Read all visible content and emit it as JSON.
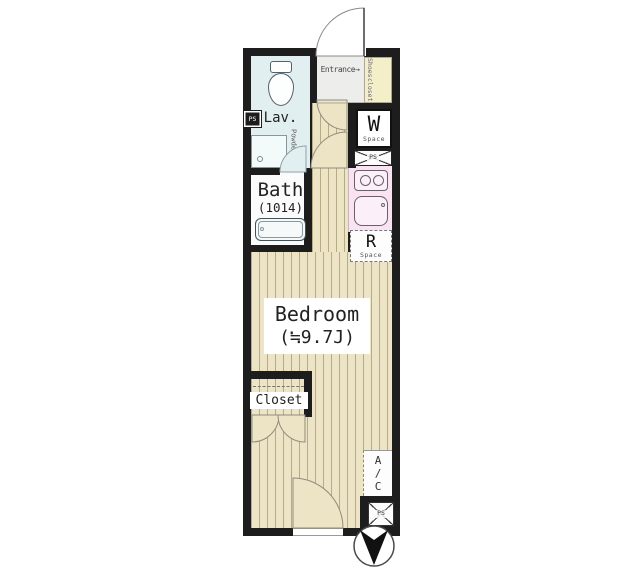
{
  "plan": {
    "entrance": {
      "label": "Entrance",
      "arrow": "→"
    },
    "shoes_closet": {
      "line1": "Shoes",
      "line2": "closet"
    },
    "lav": {
      "label": "Lav."
    },
    "powder": {
      "line1": "Powder",
      "line2": "Room"
    },
    "bath": {
      "label": "Bath",
      "size": "(1014)"
    },
    "washer": {
      "letter": "W",
      "sub": "Space"
    },
    "fridge": {
      "letter": "R",
      "sub": "Space"
    },
    "bedroom": {
      "label": "Bedroom",
      "size": "(≒9.7J)"
    },
    "closet": {
      "label": "Closet"
    },
    "ac": {
      "l1": "A",
      "l2": "/",
      "l3": "C"
    },
    "ps": {
      "label": "PS"
    },
    "colors": {
      "wall": "#1d1d1d",
      "floor_base": "#ece4c5",
      "floor_stripe": "#b5ac85",
      "lavatory": "#e2eff1",
      "kitchen": "#f9e3f3",
      "shoes_closet": "#f4eec9",
      "entrance_tile": "#ededeb",
      "bath": "#fbfbfb"
    }
  }
}
